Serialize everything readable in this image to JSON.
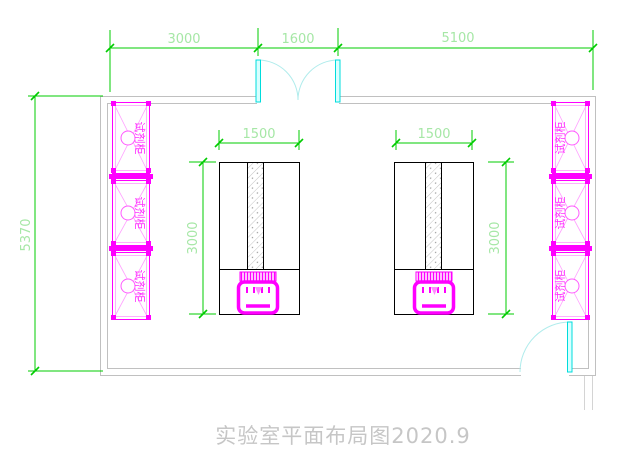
{
  "title": {
    "text": "实验室平面布局图2020.9"
  },
  "room": {
    "dims_top": [
      {
        "label": "3000"
      },
      {
        "label": "1600"
      },
      {
        "label": "5100"
      }
    ],
    "dim_left": {
      "label": "5370"
    }
  },
  "benches": {
    "left": {
      "width_label": "1500",
      "depth_label": "3000"
    },
    "right": {
      "width_label": "1500",
      "depth_label": "3000"
    }
  },
  "cabinets": {
    "left": [
      {
        "label": "试剂柜"
      },
      {
        "label": "试剂柜"
      },
      {
        "label": "试剂柜"
      }
    ],
    "right": [
      {
        "label": "试剂柜"
      },
      {
        "label": "试剂柜"
      },
      {
        "label": "试剂柜"
      }
    ]
  },
  "colors": {
    "dimension_line": "#00cc00",
    "dimension_text": "#a6e7a6",
    "wall": "#c0c0c0",
    "door_leaf": "#00dcdc",
    "door_arc": "#b0ecec",
    "equipment": "#ff00ff",
    "bench_outline": "#000000",
    "title_text": "#c6c6c6"
  }
}
